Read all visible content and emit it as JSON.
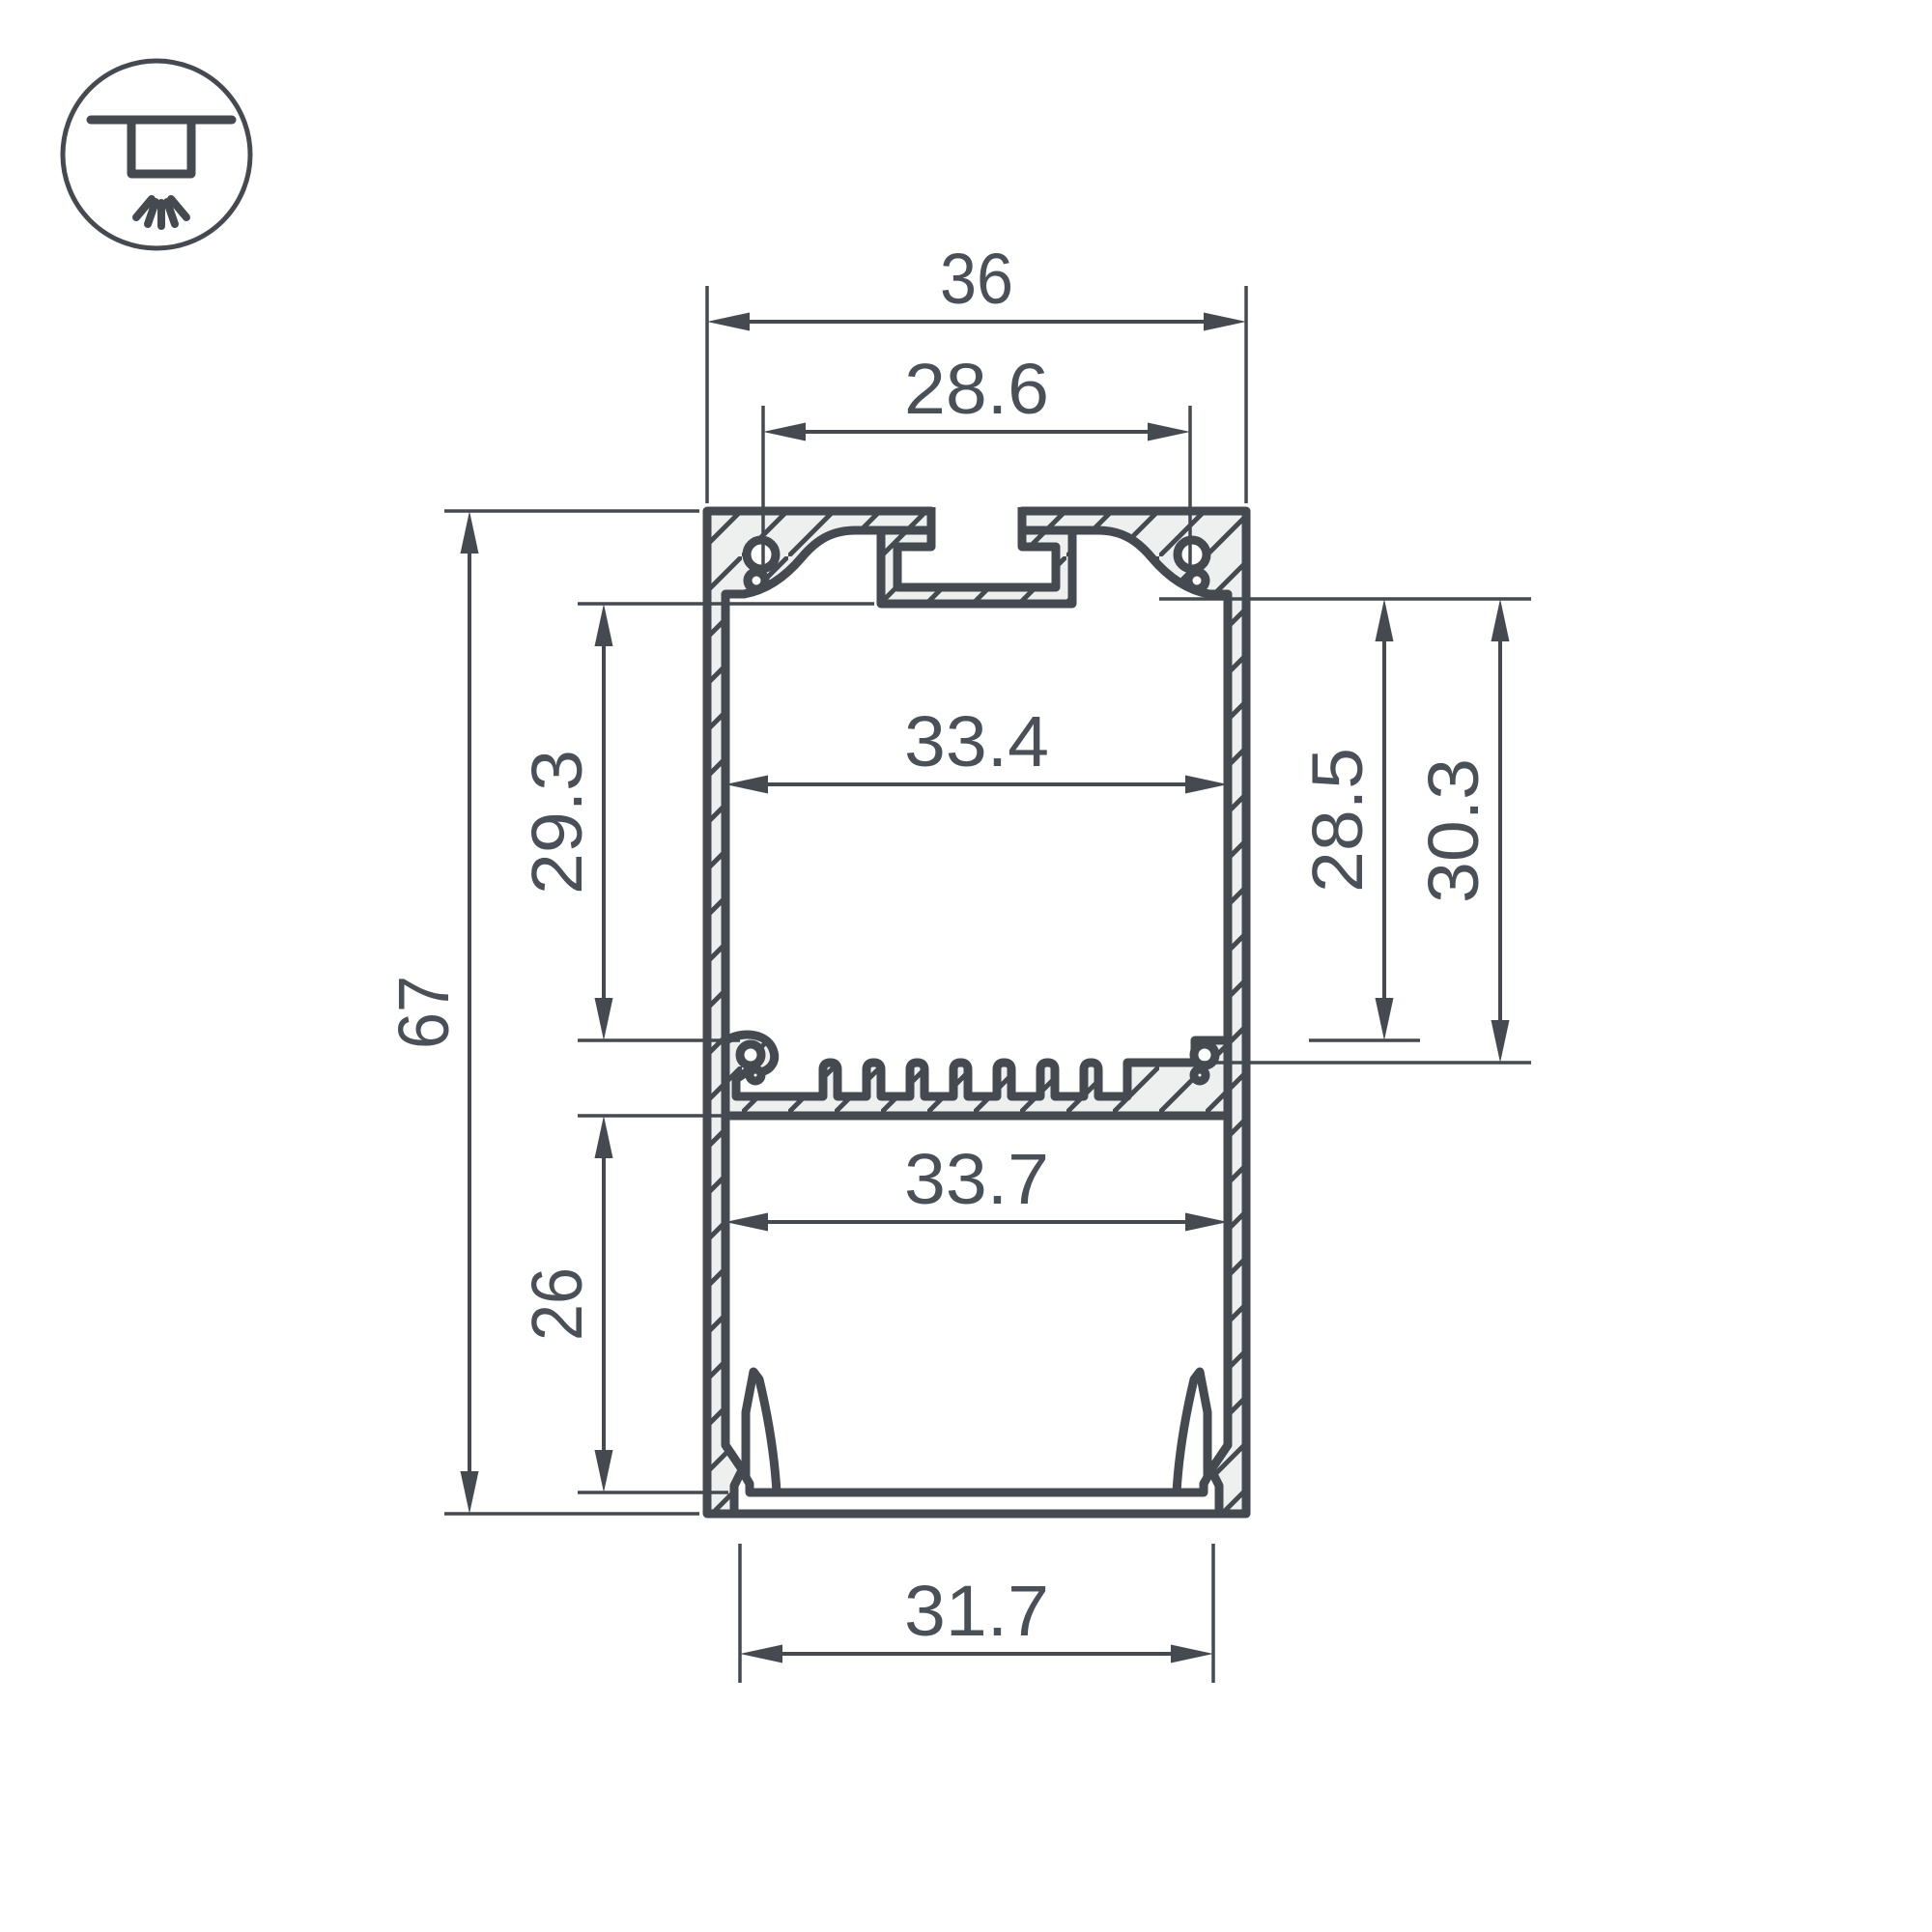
{
  "drawing": {
    "type": "aluminium-led-profile-cross-section",
    "colors": {
      "line": "#454a50",
      "fill": "#eef0f0",
      "background": "#ffffff",
      "text": "#4a5057"
    },
    "icon": {
      "name": "recessed-ceiling-light-icon"
    }
  },
  "dims": {
    "overall_width": "36",
    "mount_slot_span": "28.6",
    "upper_cavity_width": "33.4",
    "upper_cavity_height": "29.3",
    "overall_height": "67",
    "lower_cavity_height": "26",
    "right_inner_height_a": "28.5",
    "right_inner_height_b": "30.3",
    "lower_cavity_width": "33.7",
    "bottom_opening_width": "31.7"
  }
}
